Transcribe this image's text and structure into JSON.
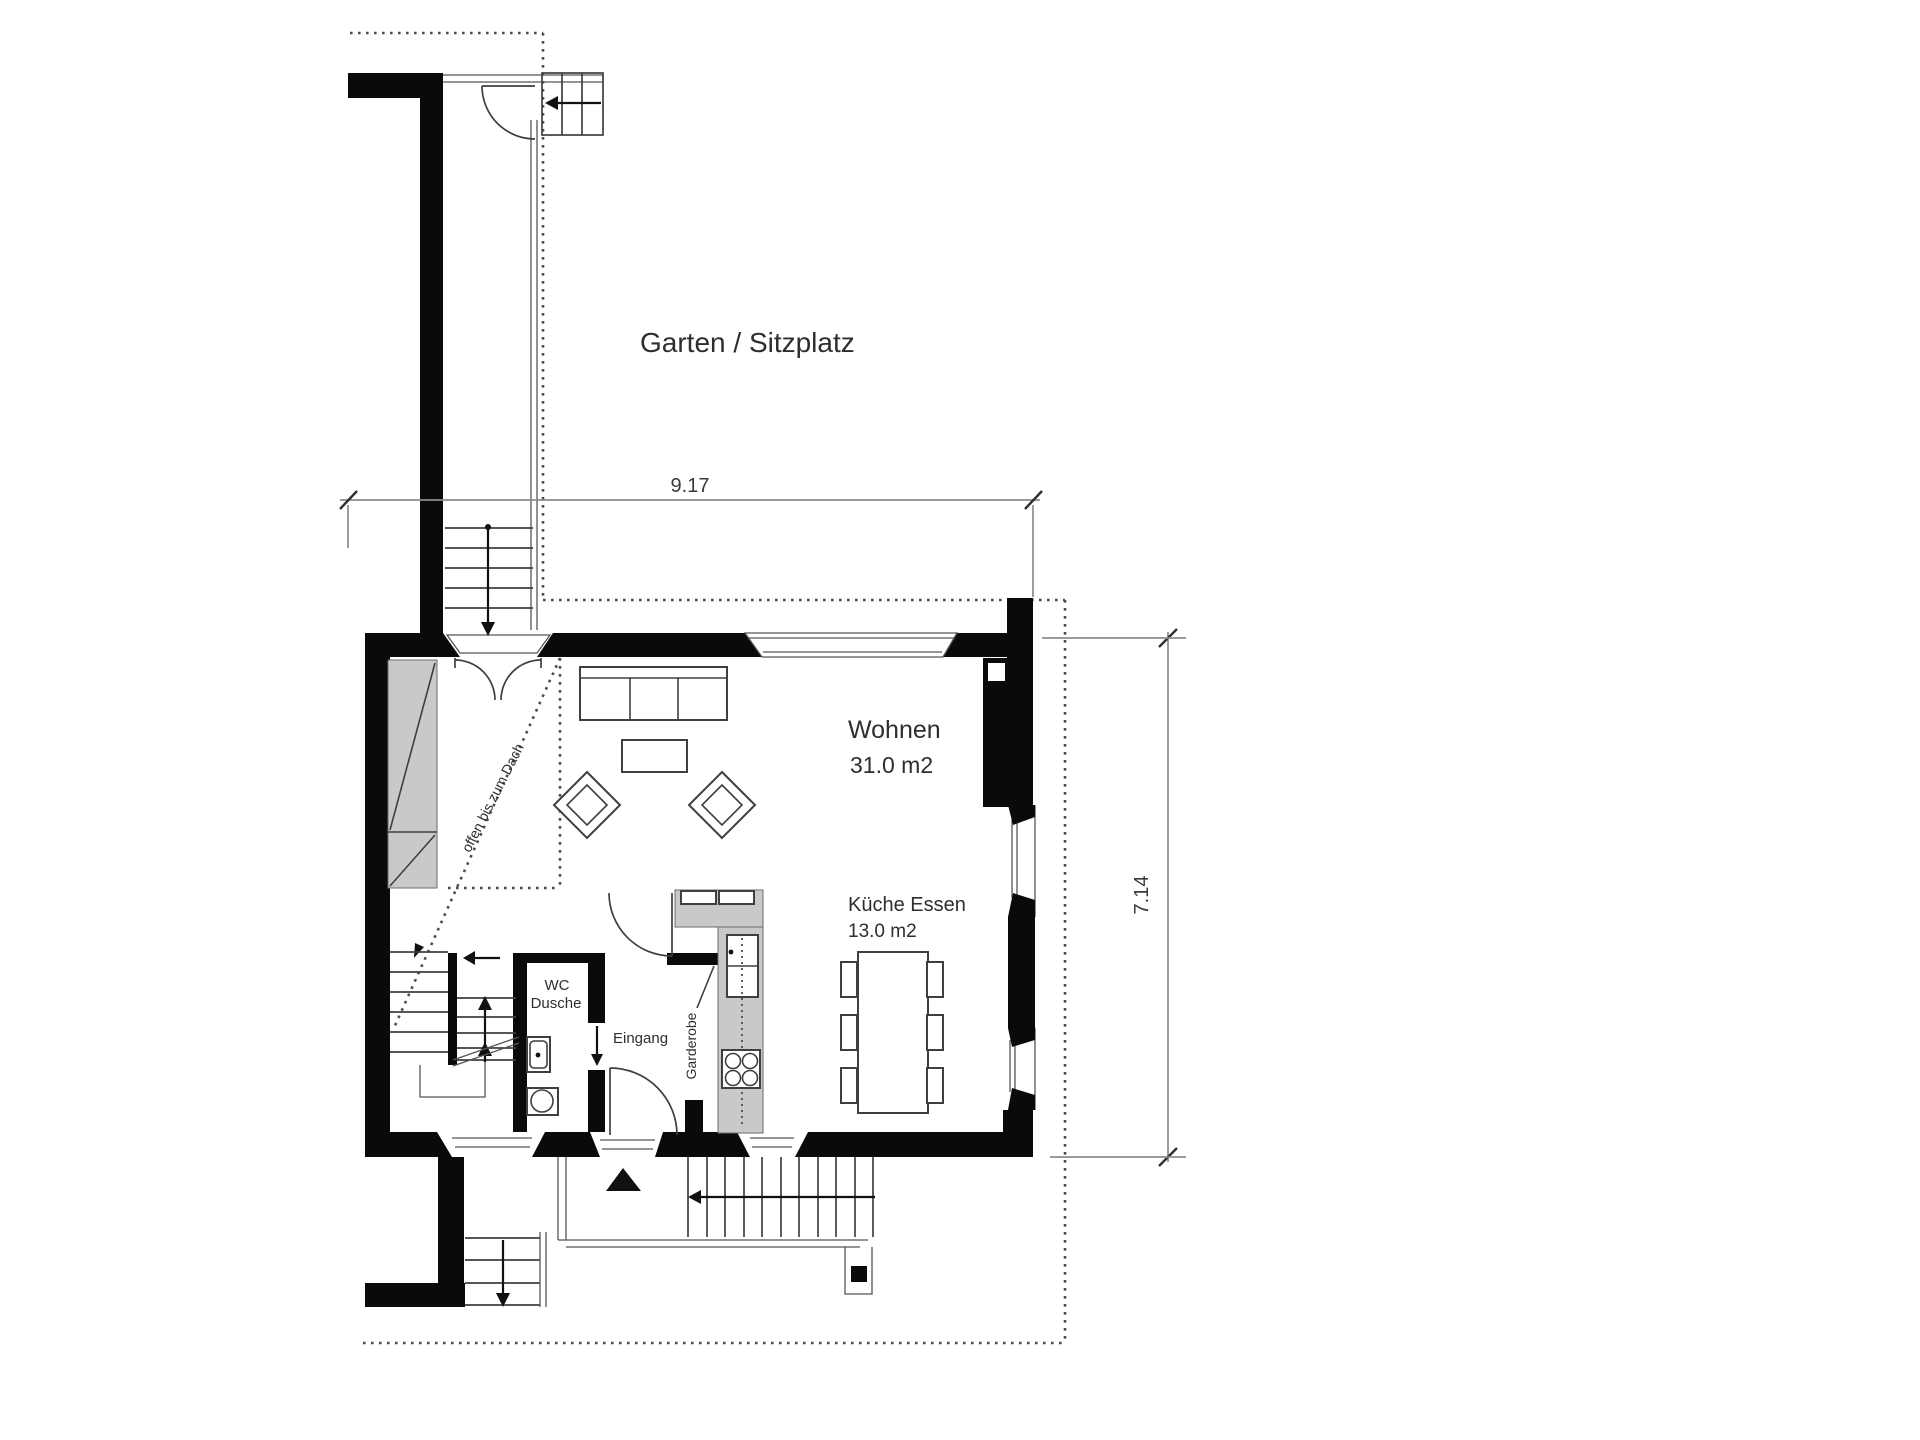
{
  "plan": {
    "garden_label": "Garten / Sitzplatz",
    "living_room": {
      "label": "Wohnen",
      "area": "31.0 m2"
    },
    "kitchen": {
      "label": "Küche Essen",
      "area": "13.0 m2"
    },
    "wc": {
      "label_line1": "WC",
      "label_line2": "Dusche"
    },
    "entrance_label": "Eingang",
    "wardrobe_label": "Garderobe",
    "open_to_roof_label": "offen bis zum Dach",
    "dimensions": {
      "width": "9.17",
      "depth": "7.14"
    }
  }
}
